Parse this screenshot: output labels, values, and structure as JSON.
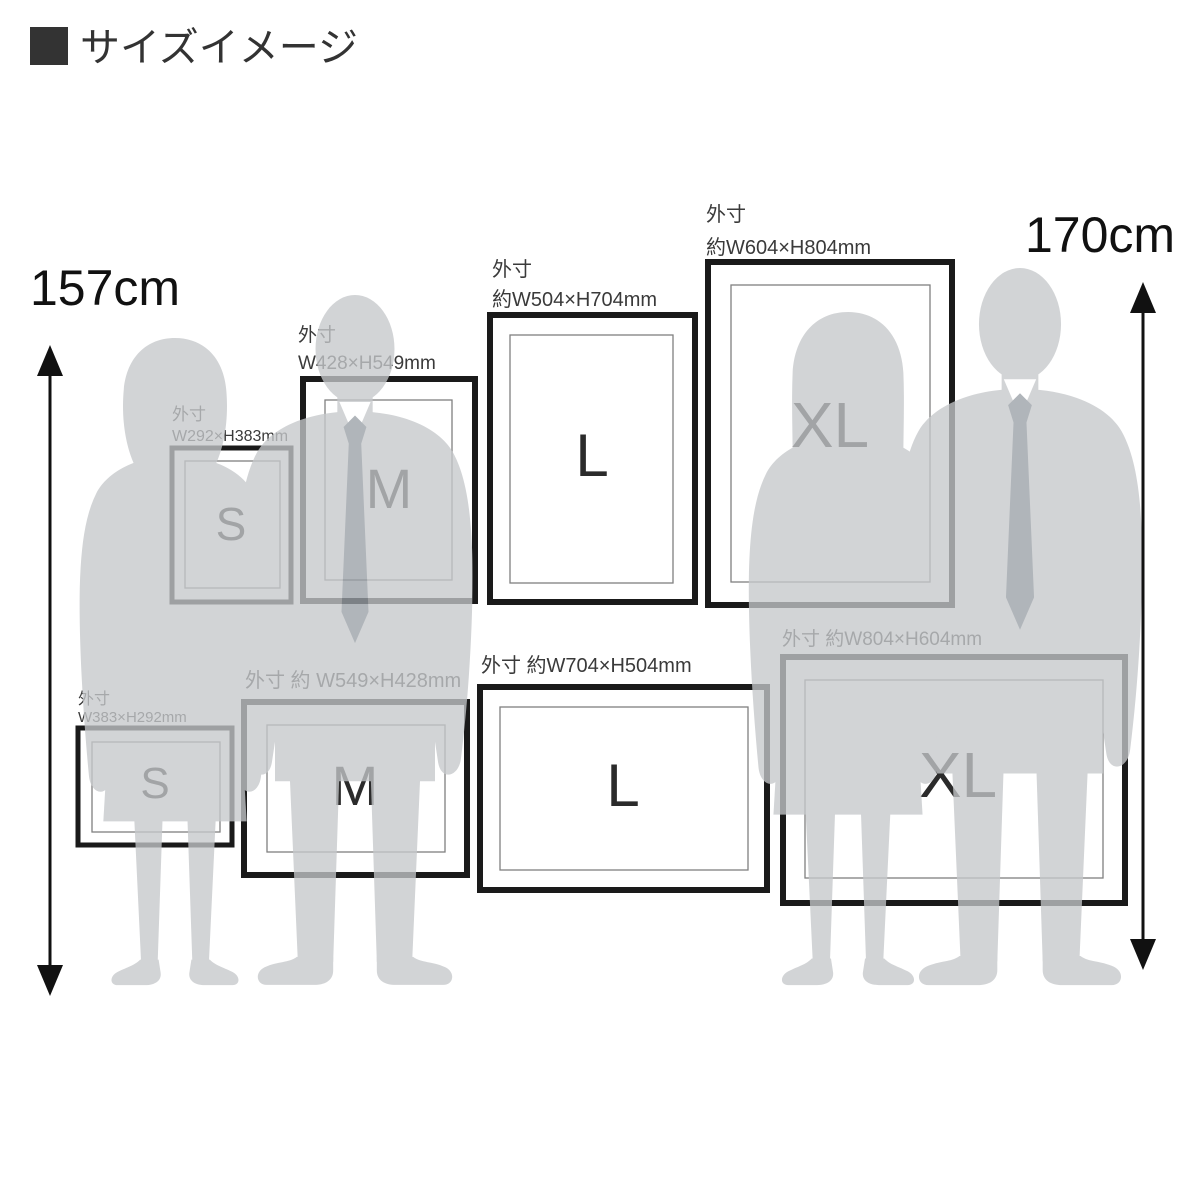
{
  "page": {
    "title": "サイズイメージ"
  },
  "height_markers": {
    "left": {
      "label": "157cm"
    },
    "right": {
      "label": "170cm"
    }
  },
  "frames": {
    "portrait": [
      {
        "size": "S",
        "dim_label_line1": "外寸",
        "dim_label_line2": "W292×H383mm"
      },
      {
        "size": "M",
        "dim_label_line1": "外寸",
        "dim_label_line2": "W428×H549mm"
      },
      {
        "size": "L",
        "dim_label_line1": "外寸",
        "dim_label_line2": "約W504×H704mm"
      },
      {
        "size": "XL",
        "dim_label_line1": "外寸",
        "dim_label_line2": "約W604×H804mm"
      }
    ],
    "landscape": [
      {
        "size": "S",
        "dim_label_line1": "外寸",
        "dim_label_line2": "W383×H292mm"
      },
      {
        "size": "M",
        "dim_label": "外寸 約 W549×H428mm"
      },
      {
        "size": "L",
        "dim_label": "外寸 約W704×H504mm"
      },
      {
        "size": "XL",
        "dim_label": "外寸 約W804×H604mm"
      }
    ]
  },
  "colors": {
    "frame_border": "#1a1a1a",
    "frame_inner_line": "#808080",
    "silhouette": "#c6c8cb",
    "tie": "#9aa0a6",
    "label_text": "#3a3a3a",
    "title_square": "#333333",
    "arrow": "#111111"
  }
}
